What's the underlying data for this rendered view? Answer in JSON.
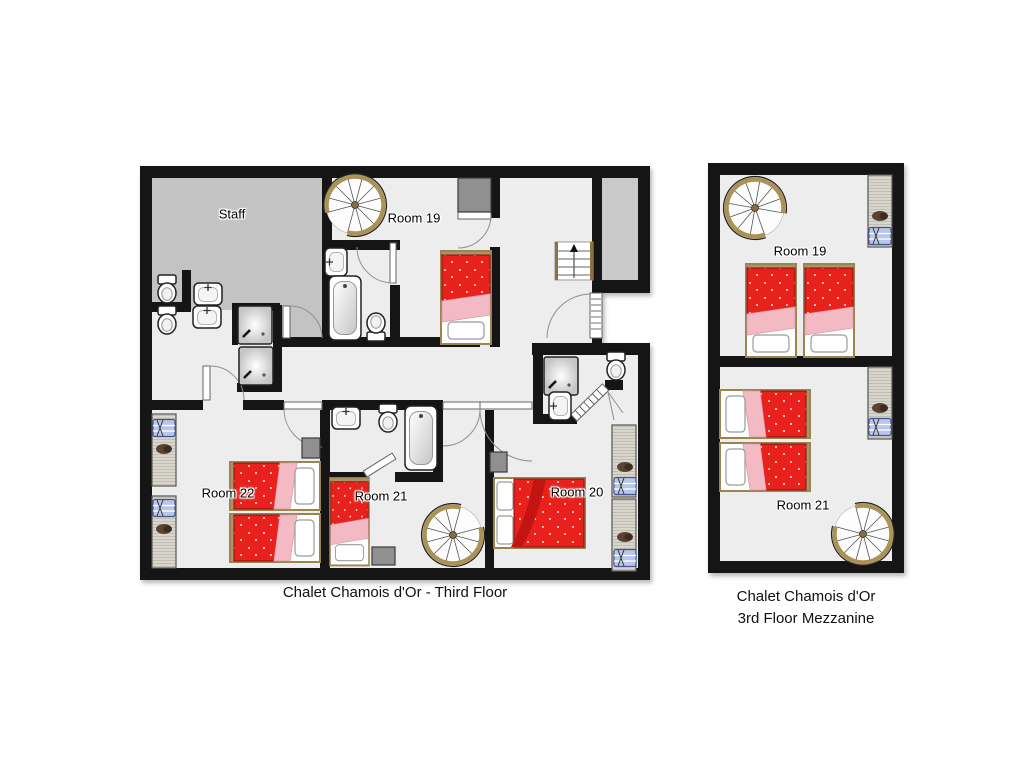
{
  "plans": {
    "third_floor": {
      "caption": "Chalet Chamois d'Or - Third Floor",
      "rooms": [
        {
          "id": "staff",
          "label": "Staff"
        },
        {
          "id": "room19",
          "label": "Room 19",
          "beds": "1 single bed"
        },
        {
          "id": "room22",
          "label": "Room 22",
          "beds": "2 single beds"
        },
        {
          "id": "room21",
          "label": "Room 21",
          "beds": "1 single bed"
        },
        {
          "id": "room20",
          "label": "Room 20",
          "beds": "1 double bed"
        }
      ],
      "features": [
        "2 spiral staircases",
        "1 straight staircase with up arrow",
        "3 en-suite bathrooms",
        "staff WC and shower area",
        "wardrobes with luggage racks in Room 22 and Room 20"
      ]
    },
    "mezzanine": {
      "caption_line1": "Chalet Chamois d'Or",
      "caption_line2": "3rd Floor Mezzanine",
      "rooms": [
        {
          "id": "room19",
          "label": "Room 19",
          "beds": "2 single beds"
        },
        {
          "id": "room21",
          "label": "Room 21",
          "beds": "2 single beds"
        }
      ],
      "features": [
        "2 spiral staircases",
        "2 wardrobes with luggage racks"
      ]
    }
  },
  "colors": {
    "background": "#ffffff",
    "wall": "#151515",
    "floor": "#ededed",
    "staff_room": "#c3c3c3",
    "stair_void": "#c9c9c9",
    "bed_red": "#e8211d",
    "bed_pink": "#f3bac4",
    "bed_frame_tan": "#9b854f",
    "wardrobe_wood": "#d8d5cc",
    "luggage_rack_blue": "#b9c6ea",
    "slipper_brown": "#5a4331",
    "stair_ring_tan": "#ab9257"
  }
}
